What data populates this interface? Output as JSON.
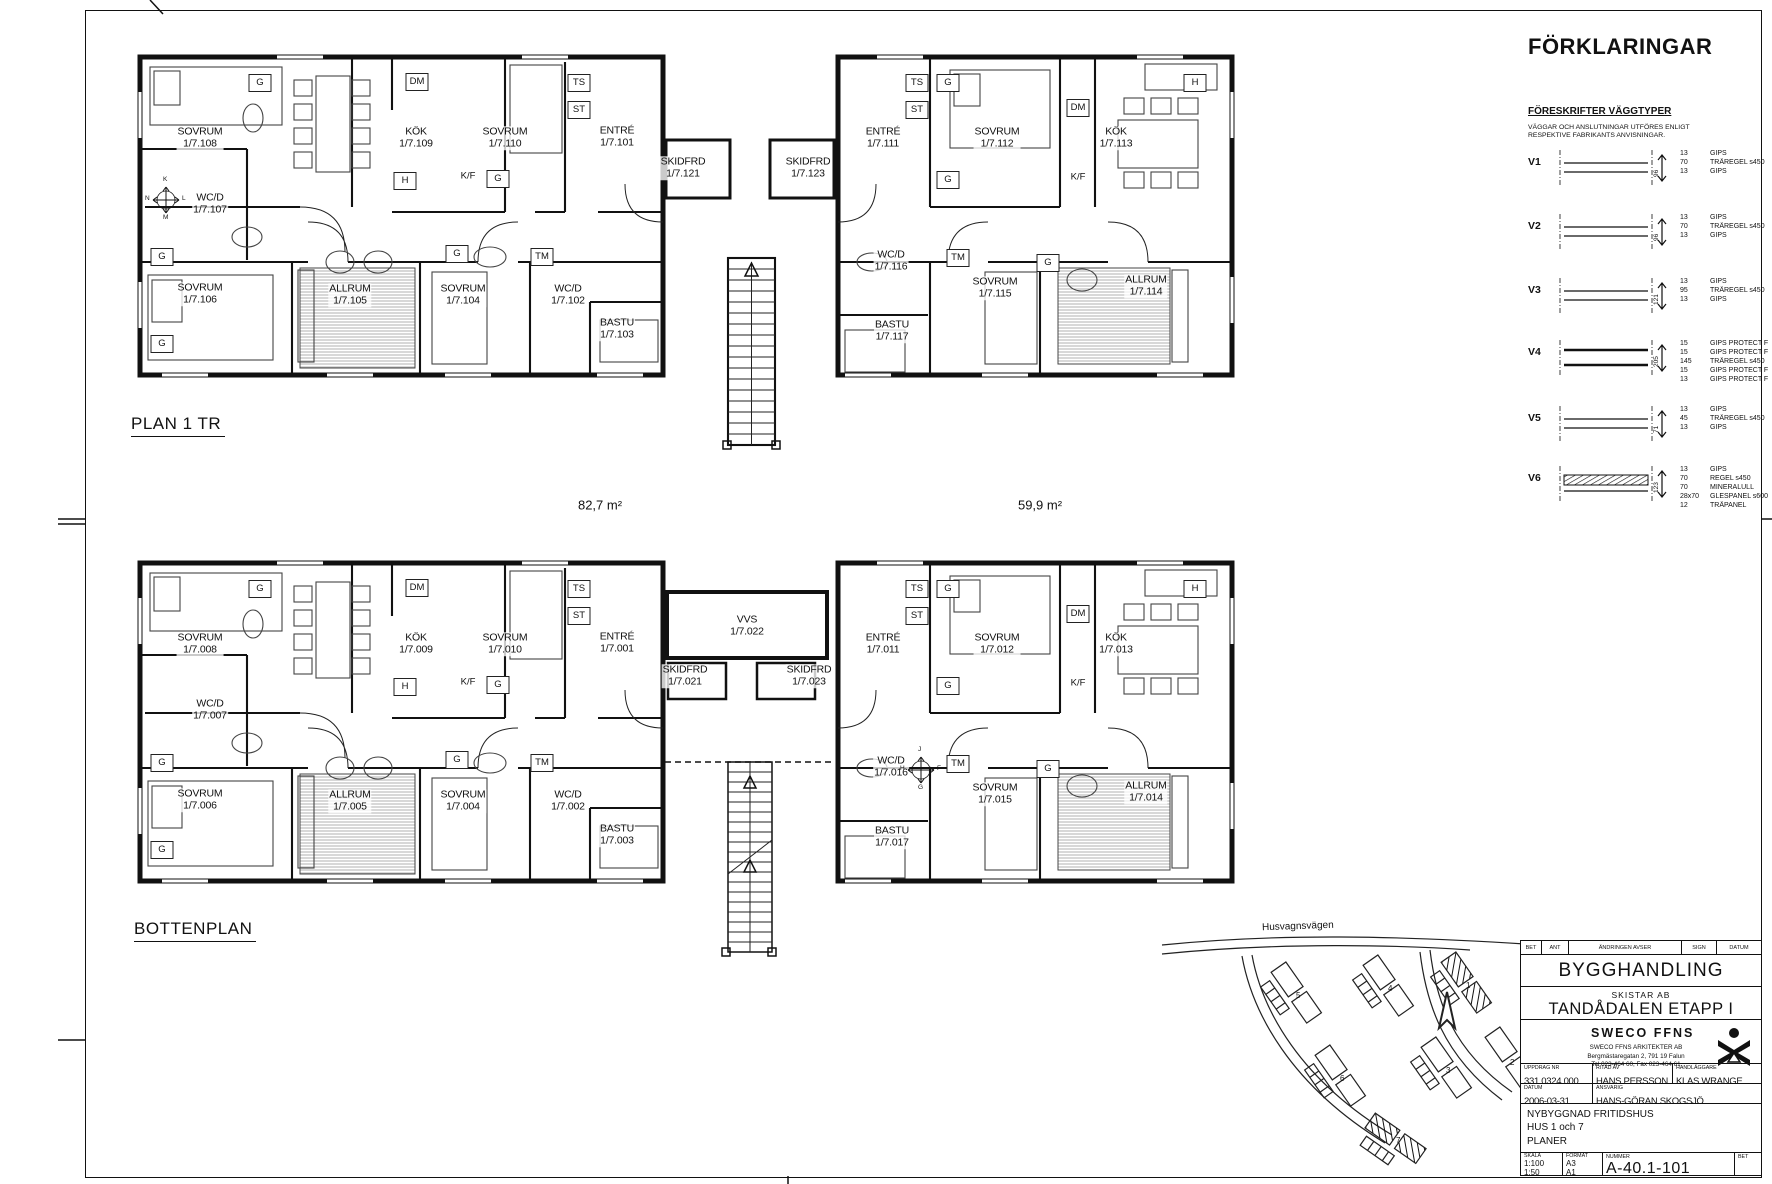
{
  "sheet": {
    "areas": [
      {
        "text": "82,7 m²",
        "x": 600,
        "y": 505
      },
      {
        "text": "59,9 m²",
        "x": 1040,
        "y": 505
      }
    ]
  },
  "plans": [
    {
      "id": "plan1",
      "title": "PLAN 1 TR",
      "title_pos": {
        "x": 131,
        "y": 414
      },
      "rooms": [
        {
          "name": "SOVRUM",
          "num": "1/7.108",
          "x": 200,
          "y": 138
        },
        {
          "name": "KÖK",
          "num": "1/7.109",
          "x": 416,
          "y": 138
        },
        {
          "name": "SOVRUM",
          "num": "1/7.110",
          "x": 505,
          "y": 138
        },
        {
          "name": "ENTRÉ",
          "num": "1/7.101",
          "x": 617,
          "y": 137
        },
        {
          "name": "SKIDFRD",
          "num": "1/7.121",
          "x": 683,
          "y": 168
        },
        {
          "name": "SKIDFRD",
          "num": "1/7.123",
          "x": 808,
          "y": 168
        },
        {
          "name": "ENTRÉ",
          "num": "1/7.111",
          "x": 883,
          "y": 138
        },
        {
          "name": "SOVRUM",
          "num": "1/7.112",
          "x": 997,
          "y": 138
        },
        {
          "name": "KÖK",
          "num": "1/7.113",
          "x": 1116,
          "y": 138
        },
        {
          "name": "WC/D",
          "num": "1/7.107",
          "x": 210,
          "y": 204
        },
        {
          "name": "SOVRUM",
          "num": "1/7.106",
          "x": 200,
          "y": 294
        },
        {
          "name": "ALLRUM",
          "num": "1/7.105",
          "x": 350,
          "y": 295
        },
        {
          "name": "SOVRUM",
          "num": "1/7.104",
          "x": 463,
          "y": 295
        },
        {
          "name": "WC/D",
          "num": "1/7.102",
          "x": 568,
          "y": 295
        },
        {
          "name": "BASTU",
          "num": "1/7.103",
          "x": 617,
          "y": 329
        },
        {
          "name": "WC/D",
          "num": "1/7.116",
          "x": 891,
          "y": 261
        },
        {
          "name": "SOVRUM",
          "num": "1/7.115",
          "x": 995,
          "y": 288
        },
        {
          "name": "ALLRUM",
          "num": "1/7.114",
          "x": 1146,
          "y": 286
        },
        {
          "name": "BASTU",
          "num": "1/7.117",
          "x": 892,
          "y": 331
        }
      ],
      "fixtures": [
        {
          "t": "G",
          "x": 260,
          "y": 83,
          "boxed": true
        },
        {
          "t": "DM",
          "x": 417,
          "y": 82,
          "boxed": true
        },
        {
          "t": "H",
          "x": 405,
          "y": 181,
          "boxed": true
        },
        {
          "t": "K/F",
          "x": 468,
          "y": 176,
          "boxed": false
        },
        {
          "t": "G",
          "x": 498,
          "y": 179,
          "boxed": true
        },
        {
          "t": "TS",
          "x": 579,
          "y": 83,
          "boxed": true
        },
        {
          "t": "ST",
          "x": 579,
          "y": 110,
          "boxed": true
        },
        {
          "t": "G",
          "x": 162,
          "y": 257,
          "boxed": true
        },
        {
          "t": "G",
          "x": 162,
          "y": 344,
          "boxed": true
        },
        {
          "t": "G",
          "x": 457,
          "y": 254,
          "boxed": true
        },
        {
          "t": "TM",
          "x": 542,
          "y": 257,
          "boxed": true
        },
        {
          "t": "TS",
          "x": 917,
          "y": 83,
          "boxed": true
        },
        {
          "t": "ST",
          "x": 917,
          "y": 110,
          "boxed": true
        },
        {
          "t": "G",
          "x": 948,
          "y": 83,
          "boxed": true
        },
        {
          "t": "G",
          "x": 948,
          "y": 180,
          "boxed": true
        },
        {
          "t": "DM",
          "x": 1078,
          "y": 108,
          "boxed": true
        },
        {
          "t": "K/F",
          "x": 1078,
          "y": 177,
          "boxed": false
        },
        {
          "t": "H",
          "x": 1195,
          "y": 83,
          "boxed": true
        },
        {
          "t": "TM",
          "x": 958,
          "y": 258,
          "boxed": true
        },
        {
          "t": "G",
          "x": 1048,
          "y": 263,
          "boxed": true
        }
      ],
      "compass": {
        "x": 166,
        "y": 200,
        "top": "K",
        "left": "N",
        "right": "L",
        "bottom": "M"
      }
    },
    {
      "id": "bottenplan",
      "title": "BOTTENPLAN",
      "title_pos": {
        "x": 134,
        "y": 919
      },
      "rooms": [
        {
          "name": "SOVRUM",
          "num": "1/7.008",
          "x": 200,
          "y": 644
        },
        {
          "name": "KÖK",
          "num": "1/7.009",
          "x": 416,
          "y": 644
        },
        {
          "name": "SOVRUM",
          "num": "1/7.010",
          "x": 505,
          "y": 644
        },
        {
          "name": "ENTRÉ",
          "num": "1/7.001",
          "x": 617,
          "y": 643
        },
        {
          "name": "VVS",
          "num": "1/7.022",
          "x": 747,
          "y": 626
        },
        {
          "name": "SKIDFRD",
          "num": "1/7.021",
          "x": 685,
          "y": 676
        },
        {
          "name": "SKIDFRD",
          "num": "1/7.023",
          "x": 809,
          "y": 676
        },
        {
          "name": "ENTRÉ",
          "num": "1/7.011",
          "x": 883,
          "y": 644
        },
        {
          "name": "SOVRUM",
          "num": "1/7.012",
          "x": 997,
          "y": 644
        },
        {
          "name": "KÖK",
          "num": "1/7.013",
          "x": 1116,
          "y": 644
        },
        {
          "name": "WC/D",
          "num": "1/7.007",
          "x": 210,
          "y": 710
        },
        {
          "name": "SOVRUM",
          "num": "1/7.006",
          "x": 200,
          "y": 800
        },
        {
          "name": "ALLRUM",
          "num": "1/7.005",
          "x": 350,
          "y": 801
        },
        {
          "name": "SOVRUM",
          "num": "1/7.004",
          "x": 463,
          "y": 801
        },
        {
          "name": "WC/D",
          "num": "1/7.002",
          "x": 568,
          "y": 801
        },
        {
          "name": "BASTU",
          "num": "1/7.003",
          "x": 617,
          "y": 835
        },
        {
          "name": "WC/D",
          "num": "1/7.016",
          "x": 891,
          "y": 767
        },
        {
          "name": "SOVRUM",
          "num": "1/7.015",
          "x": 995,
          "y": 794
        },
        {
          "name": "ALLRUM",
          "num": "1/7.014",
          "x": 1146,
          "y": 792
        },
        {
          "name": "BASTU",
          "num": "1/7.017",
          "x": 892,
          "y": 837
        }
      ],
      "fixtures": [
        {
          "t": "G",
          "x": 260,
          "y": 589,
          "boxed": true
        },
        {
          "t": "DM",
          "x": 417,
          "y": 588,
          "boxed": true
        },
        {
          "t": "H",
          "x": 405,
          "y": 687,
          "boxed": true
        },
        {
          "t": "K/F",
          "x": 468,
          "y": 682,
          "boxed": false
        },
        {
          "t": "G",
          "x": 498,
          "y": 685,
          "boxed": true
        },
        {
          "t": "TS",
          "x": 579,
          "y": 589,
          "boxed": true
        },
        {
          "t": "ST",
          "x": 579,
          "y": 616,
          "boxed": true
        },
        {
          "t": "G",
          "x": 162,
          "y": 763,
          "boxed": true
        },
        {
          "t": "G",
          "x": 162,
          "y": 850,
          "boxed": true
        },
        {
          "t": "G",
          "x": 457,
          "y": 760,
          "boxed": true
        },
        {
          "t": "TM",
          "x": 542,
          "y": 763,
          "boxed": true
        },
        {
          "t": "TS",
          "x": 917,
          "y": 589,
          "boxed": true
        },
        {
          "t": "ST",
          "x": 917,
          "y": 616,
          "boxed": true
        },
        {
          "t": "G",
          "x": 948,
          "y": 589,
          "boxed": true
        },
        {
          "t": "G",
          "x": 948,
          "y": 686,
          "boxed": true
        },
        {
          "t": "DM",
          "x": 1078,
          "y": 614,
          "boxed": true
        },
        {
          "t": "K/F",
          "x": 1078,
          "y": 683,
          "boxed": false
        },
        {
          "t": "H",
          "x": 1195,
          "y": 589,
          "boxed": true
        },
        {
          "t": "TM",
          "x": 958,
          "y": 764,
          "boxed": true
        },
        {
          "t": "G",
          "x": 1048,
          "y": 769,
          "boxed": true
        }
      ],
      "compass": {
        "x": 921,
        "y": 770,
        "top": "J",
        "left": "H",
        "right": "F",
        "bottom": "G"
      }
    }
  ],
  "legend": {
    "title": "FÖRKLARINGAR",
    "subtitle": "FÖRESKRIFTER VÄGGTYPER",
    "note": "VÄGGAR OCH ANSLUTNINGAR UTFÖRES ENLIGT RESPEKTIVE FABRIKANTS ANVISNINGAR.",
    "wall_types": [
      {
        "id": "V1",
        "glyph": "std",
        "total": "96",
        "y": 148,
        "layers": [
          [
            "13",
            "GIPS"
          ],
          [
            "70",
            "TRÄREGEL s450"
          ],
          [
            "13",
            "GIPS"
          ]
        ]
      },
      {
        "id": "V2",
        "glyph": "std",
        "total": "96",
        "y": 212,
        "layers": [
          [
            "13",
            "GIPS"
          ],
          [
            "70",
            "TRÄREGEL s450"
          ],
          [
            "13",
            "GIPS"
          ]
        ]
      },
      {
        "id": "V3",
        "glyph": "std",
        "total": "121",
        "y": 276,
        "layers": [
          [
            "13",
            "GIPS"
          ],
          [
            "95",
            "TRÄREGEL s450"
          ],
          [
            "13",
            "GIPS"
          ]
        ]
      },
      {
        "id": "V4",
        "glyph": "thick",
        "total": "205",
        "y": 338,
        "layers": [
          [
            "15",
            "GIPS PROTECT F"
          ],
          [
            "15",
            "GIPS PROTECT F"
          ],
          [
            "145",
            "TRÄREGEL s450"
          ],
          [
            "15",
            "GIPS PROTECT F"
          ],
          [
            "13",
            "GIPS PROTECT F"
          ]
        ]
      },
      {
        "id": "V5",
        "glyph": "std",
        "total": "71",
        "y": 404,
        "layers": [
          [
            "13",
            "GIPS"
          ],
          [
            "45",
            "TRÄREGEL s450"
          ],
          [
            "13",
            "GIPS"
          ]
        ]
      },
      {
        "id": "V6",
        "glyph": "hatched",
        "total": "123",
        "y": 464,
        "layers": [
          [
            "13",
            "GIPS"
          ],
          [
            "70",
            "REGEL s450"
          ],
          [
            "70",
            "MINERALULL"
          ],
          [
            "28x70",
            "GLESPANEL s600"
          ],
          [
            "12",
            "TRÄPANEL"
          ]
        ]
      }
    ]
  },
  "title_block": {
    "rev_header": [
      "BET",
      "ANT",
      "ÄNDRINGEN AVSER",
      "SIGN",
      "DATUM"
    ],
    "doc_status": "BYGGHANDLING",
    "client": "SKISTAR AB",
    "project": "TANDÅDALEN ETAPP I",
    "firm": "SWECO FFNS",
    "firm_line1": "SWECO FFNS ARKITEKTER AB",
    "firm_line2": "Bergmästaregatan 2, 791 19 Falun",
    "firm_line3": "Tel 023-464 60, Fax 023-464 61",
    "labels": {
      "uppdrag": "UPPDRAG NR",
      "ritad": "RITAD AV",
      "handl": "HANDLÄGGARE",
      "datum": "DATUM",
      "ansvarig": "ANSVARIG",
      "skala": "SKALA",
      "format": "FORMAT",
      "nummer": "NUMMER",
      "bet": "BET"
    },
    "uppdrag_nr": "331 0324.000",
    "ritad_av": "HANS PERSSON",
    "handlaggare": "KLAS WRANGE",
    "datum": "2006-03-31",
    "ansvarig": "HANS-GÖRAN SKOGSJÖ",
    "description": [
      "NYBYGGNAD FRITIDSHUS",
      "HUS 1 och 7",
      "PLANER"
    ],
    "skala": [
      "1:100",
      "1:50"
    ],
    "format": [
      "A3",
      "A1"
    ],
    "nummer": "A-40.1-101"
  },
  "site_map": {
    "road_label": "Husvagnsvägen",
    "house_numbers": [
      "5",
      "4",
      "1",
      "6",
      "3",
      "2",
      "7"
    ]
  }
}
